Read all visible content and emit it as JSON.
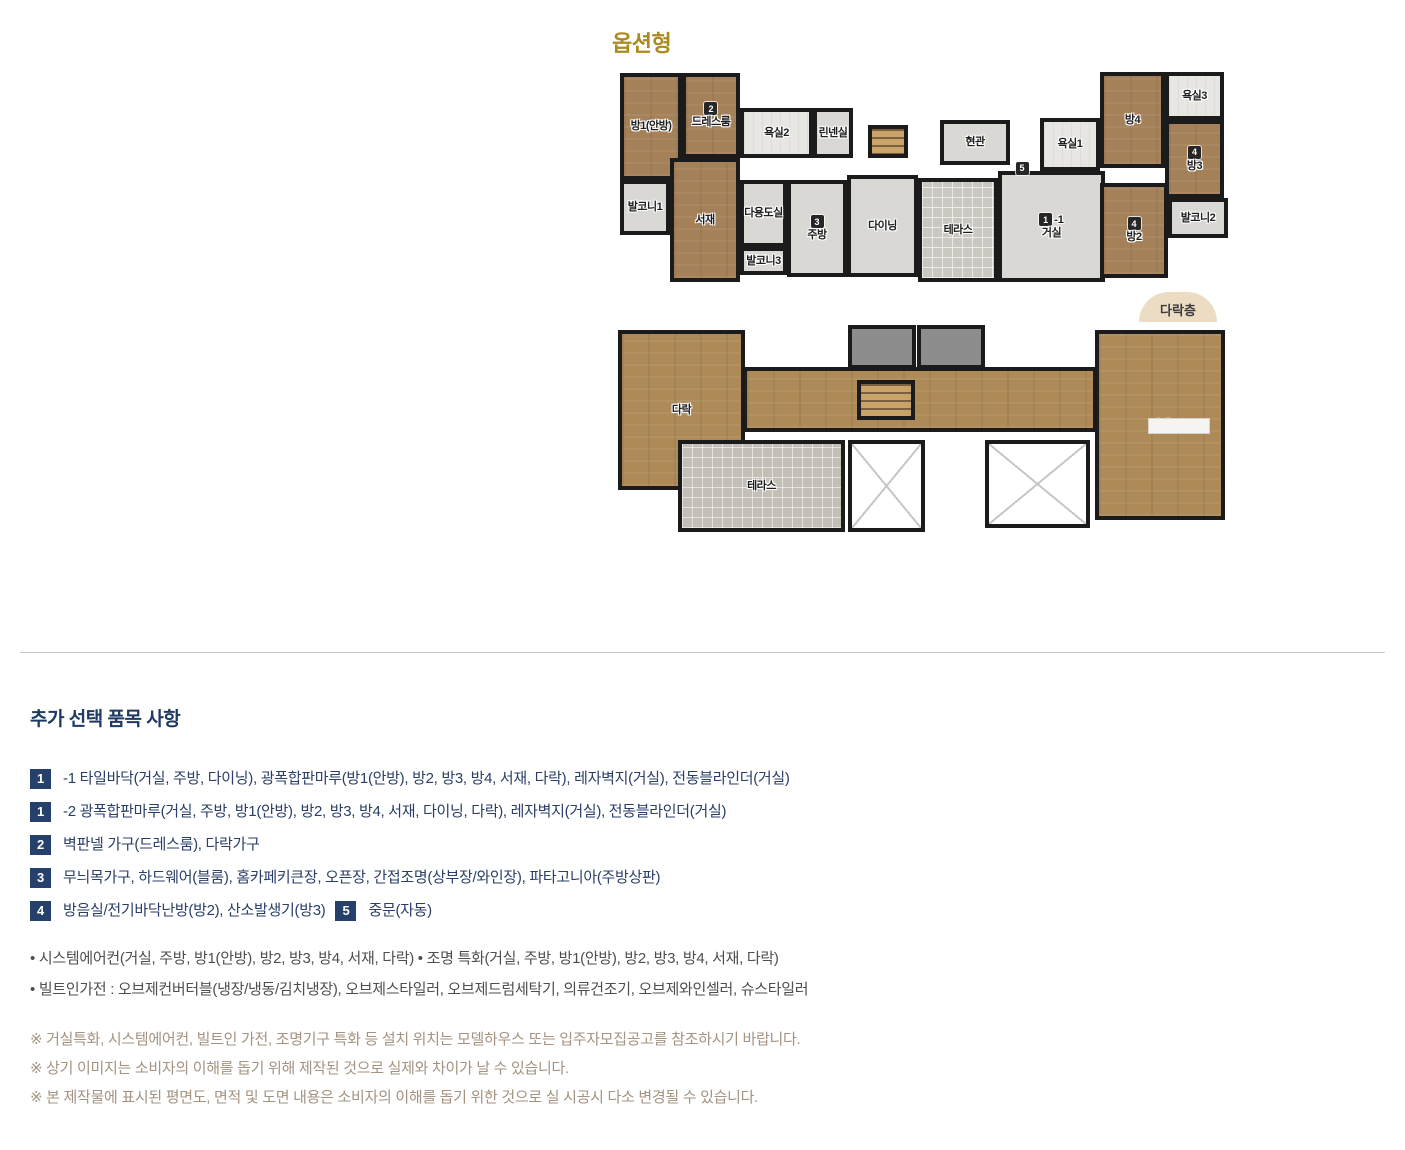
{
  "header": {
    "title": "옵션형"
  },
  "colors": {
    "gold": "#ab8a1f",
    "navy-h": "#1e3a63",
    "navy-t": "#2a3e68",
    "badge": "#24406b",
    "tan": "#a39380",
    "bullet": "#4e4e4e",
    "wall": "#1b1b1b",
    "wood": "#a5815a",
    "wood2": "#ad8a58",
    "fgray": "#d9d8d4",
    "div": "#c9c9c9",
    "atticbg": "#ecdcc3"
  },
  "plans": {
    "lower_tag": "다락층",
    "upper": {
      "rooms": [
        {
          "name": "room-bang1-master",
          "label": "방1(안방)",
          "x": 3,
          "y": 6,
          "w": 62,
          "h": 107,
          "fill": "wood"
        },
        {
          "name": "room-dressroom",
          "label": "드레스룸",
          "badge": "2",
          "x": 65,
          "y": 6,
          "w": 58,
          "h": 85,
          "fill": "wood"
        },
        {
          "name": "room-bath2",
          "label": "욕실2",
          "x": 123,
          "y": 41,
          "w": 73,
          "h": 50,
          "fill": "bath"
        },
        {
          "name": "room-linen",
          "label": "린넨실",
          "x": 196,
          "y": 41,
          "w": 40,
          "h": 50,
          "fill": "gray"
        },
        {
          "name": "room-stairs-upper",
          "label": "",
          "x": 251,
          "y": 58,
          "w": 40,
          "h": 33,
          "fill": "stairs"
        },
        {
          "name": "room-entry",
          "label": "현관",
          "x": 323,
          "y": 53,
          "w": 70,
          "h": 45,
          "fill": "gray"
        },
        {
          "name": "room-bath1",
          "label": "욕실1",
          "x": 423,
          "y": 51,
          "w": 60,
          "h": 53,
          "fill": "bath"
        },
        {
          "name": "room-bang4",
          "label": "방4",
          "x": 483,
          "y": 5,
          "w": 65,
          "h": 96,
          "fill": "wood"
        },
        {
          "name": "room-bath3",
          "label": "욕실3",
          "x": 548,
          "y": 5,
          "w": 59,
          "h": 48,
          "fill": "bath"
        },
        {
          "name": "room-bang3",
          "label": "방3",
          "badge": "4",
          "x": 548,
          "y": 53,
          "w": 59,
          "h": 78,
          "fill": "wood"
        },
        {
          "name": "room-balcony1",
          "label": "발코니1",
          "x": 3,
          "y": 113,
          "w": 50,
          "h": 55,
          "fill": "gray"
        },
        {
          "name": "room-study",
          "label": "서재",
          "x": 53,
          "y": 91,
          "w": 70,
          "h": 124,
          "fill": "wood"
        },
        {
          "name": "room-utility",
          "label": "다용도실",
          "x": 123,
          "y": 113,
          "w": 47,
          "h": 67,
          "fill": "gray"
        },
        {
          "name": "room-balcony3",
          "label": "발코니3",
          "x": 123,
          "y": 180,
          "w": 47,
          "h": 28,
          "fill": "gray"
        },
        {
          "name": "room-kitchen",
          "label": "주방",
          "badge": "3",
          "x": 170,
          "y": 113,
          "w": 60,
          "h": 97,
          "fill": "gray"
        },
        {
          "name": "room-dining",
          "label": "다이닝",
          "x": 230,
          "y": 108,
          "w": 71,
          "h": 102,
          "fill": "gray"
        },
        {
          "name": "room-terrace-upper",
          "label": "테라스",
          "x": 301,
          "y": 111,
          "w": 80,
          "h": 104,
          "fill": "terrace"
        },
        {
          "name": "room-living",
          "label": "거실",
          "badge": "1",
          "badge_suffix": "-1",
          "x": 381,
          "y": 104,
          "w": 107,
          "h": 111,
          "fill": "gray"
        },
        {
          "name": "room-bang2",
          "label": "방2",
          "badge": "4",
          "x": 483,
          "y": 116,
          "w": 68,
          "h": 95,
          "fill": "wood"
        },
        {
          "name": "room-balcony2",
          "label": "발코니2",
          "x": 551,
          "y": 131,
          "w": 60,
          "h": 40,
          "fill": "gray"
        },
        {
          "name": "marker-badge-5",
          "label": "",
          "badge": "5",
          "x": 395,
          "y": 92,
          "w": 20,
          "h": 18,
          "fill": "none"
        }
      ]
    },
    "lower": {
      "rooms": [
        {
          "name": "room-attic-left",
          "label": "다락",
          "x": 1,
          "y": 8,
          "w": 127,
          "h": 160,
          "fill": "wood2"
        },
        {
          "name": "room-corridor",
          "label": "",
          "x": 126,
          "y": 45,
          "w": 354,
          "h": 65,
          "fill": "wood2"
        },
        {
          "name": "room-grayblock-1",
          "label": "",
          "x": 231,
          "y": 3,
          "w": 68,
          "h": 44,
          "fill": "grayblock"
        },
        {
          "name": "room-grayblock-2",
          "label": "",
          "x": 300,
          "y": 3,
          "w": 68,
          "h": 44,
          "fill": "grayblock"
        },
        {
          "name": "room-stairs-lower",
          "label": "",
          "x": 240,
          "y": 58,
          "w": 58,
          "h": 40,
          "fill": "stairs"
        },
        {
          "name": "room-attic-right",
          "label": "다락",
          "x": 478,
          "y": 8,
          "w": 130,
          "h": 190,
          "fill": "wood2"
        },
        {
          "name": "room-attic-slot",
          "label": "",
          "x": 531,
          "y": 96,
          "w": 62,
          "h": 16,
          "fill": "slot"
        },
        {
          "name": "room-terrace-lower",
          "label": "테라스",
          "x": 61,
          "y": 118,
          "w": 167,
          "h": 92,
          "fill": "terrace2"
        },
        {
          "name": "room-void-left",
          "label": "",
          "x": 231,
          "y": 118,
          "w": 77,
          "h": 92,
          "fill": "void"
        },
        {
          "name": "room-void-right",
          "label": "",
          "x": 368,
          "y": 118,
          "w": 105,
          "h": 88,
          "fill": "void"
        }
      ]
    }
  },
  "info": {
    "heading": "추가 선택 품목 사항",
    "items": [
      {
        "segments": [
          {
            "num": "1",
            "text": "-1 타일바닥(거실, 주방, 다이닝), 광폭합판마루(방1(안방), 방2, 방3, 방4, 서재, 다락), 레자벽지(거실), 전동블라인더(거실)"
          }
        ]
      },
      {
        "segments": [
          {
            "num": "1",
            "text": "-2 광폭합판마루(거실, 주방, 방1(안방), 방2, 방3, 방4, 서재, 다이닝, 다락), 레자벽지(거실), 전동블라인더(거실)"
          }
        ]
      },
      {
        "segments": [
          {
            "num": "2",
            "text": "벽판넬 가구(드레스룸), 다락가구"
          }
        ]
      },
      {
        "segments": [
          {
            "num": "3",
            "text": "무늬목가구, 하드웨어(블룸), 홈카페키큰장, 오픈장, 간접조명(상부장/와인장), 파타고니아(주방상판)"
          }
        ]
      },
      {
        "segments": [
          {
            "num": "4",
            "text": "방음실/전기바닥난방(방2), 산소발생기(방3)"
          },
          {
            "num": "5",
            "text": "중문(자동)"
          }
        ]
      }
    ],
    "bullets": [
      "시스템에어컨(거실, 주방, 방1(안방), 방2, 방3, 방4, 서재, 다락) • 조명 특화(거실, 주방, 방1(안방), 방2, 방3, 방4, 서재, 다락)",
      "빌트인가전 : 오브제컨버터블(냉장/냉동/김치냉장), 오브제스타일러, 오브제드럼세탁기, 의류건조기, 오브제와인셀러, 슈스타일러"
    ],
    "notes": [
      "※ 거실특화, 시스템에어컨, 빌트인 가전, 조명기구 특화 등 설치 위치는 모델하우스 또는 입주자모집공고를 참조하시기 바랍니다.",
      "※ 상기 이미지는 소비자의 이해를 돕기 위해 제작된 것으로 실제와 차이가 날 수 있습니다.",
      "※ 본 제작물에 표시된 평면도, 면적 및 도면 내용은 소비자의 이해를 돕기 위한 것으로 실 시공시 다소 변경될 수 있습니다."
    ]
  }
}
